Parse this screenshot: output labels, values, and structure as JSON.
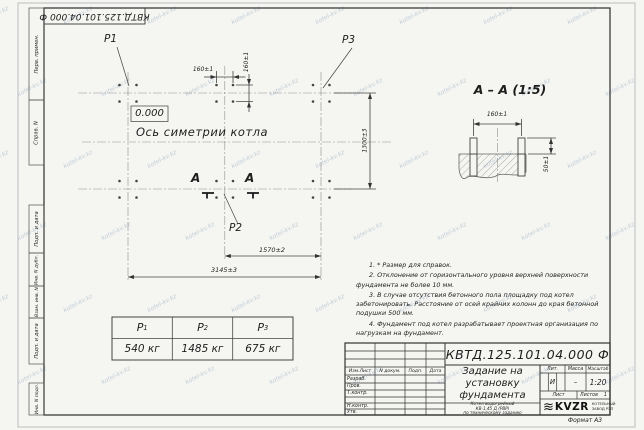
{
  "meta": {
    "doc_number": "КВТД.125.101.04.000  Ф",
    "watermark": "kotel-kv.kz",
    "format_label": "Формат А3"
  },
  "frame": {
    "labels": [
      "Перв. примен.",
      "Справ. N",
      "Подп. и дата",
      "Инв. N дубл.",
      "Взам. инв. N",
      "Подп. и дата",
      "Инв. N подл."
    ]
  },
  "plan": {
    "level_mark": "0.000",
    "axis_label": "Ось симетрии котла",
    "load_p1": "P1",
    "load_p2": "P2",
    "load_p3": "P3",
    "section_letter": "А",
    "dim_bolt_horizontal": "160±1",
    "dim_bolt_vertical": "160±1",
    "dim_height": "1300±3",
    "dim_half_width": "1570±2",
    "dim_full_width": "3145±3"
  },
  "section": {
    "title": "А – А (1:5)",
    "dim_spacing": "160±1",
    "dim_protrusion": "50±1"
  },
  "load_table": {
    "headers": [
      {
        "base": "P",
        "sub": "1"
      },
      {
        "base": "P",
        "sub": "2"
      },
      {
        "base": "P",
        "sub": "3"
      }
    ],
    "values": [
      "540 кг",
      "1485 кг",
      "675 кг"
    ]
  },
  "notes": [
    "1. * Размер для справок.",
    "2. Отклонение от горизонтального уровня верхней поверхности фундамента не более 10 мм.",
    "3. В случае отсутствия бетонного пола площадку под котел забетонировать. Расстояние от осей крайних колонн до края бетонной подушки 500 мм.",
    "4. Фундамент под котел разрабатывает проектная организация по нагрузкам на фундамент."
  ],
  "title_block": {
    "doc_number": "КВТД.125.101.04.000  Ф",
    "title_line1": "Задание на",
    "title_line2": "установку",
    "title_line3": "фундамента",
    "subtitle_line1": "Котел водогрейный",
    "subtitle_line2": "КВ-1,45 Д (РВР)",
    "subtitle_line3": "по техническому заданию",
    "col_izm": "Изм.Лист",
    "col_doc": "N докум.",
    "col_sign": "Подп.",
    "col_date": "Дата",
    "row_razrab": "Разраб.",
    "row_prov": "Пров.",
    "row_tkontr": "Т.контр.",
    "row_nkontr": "Н.контр.",
    "row_utv": "Утв.",
    "lit_label": "Лит.",
    "mass_label": "Масса",
    "scale_label": "Масштаб",
    "lit_value": "И",
    "mass_value": "–",
    "scale_value": "1:20",
    "sheet_label": "Лист",
    "sheets_label": "Листов",
    "sheets_value": "1",
    "logo_text": "KVZR",
    "logo_sub1": "КОТЕЛЬНЫЙ",
    "logo_sub2": "ЗАВОД РЭП"
  }
}
